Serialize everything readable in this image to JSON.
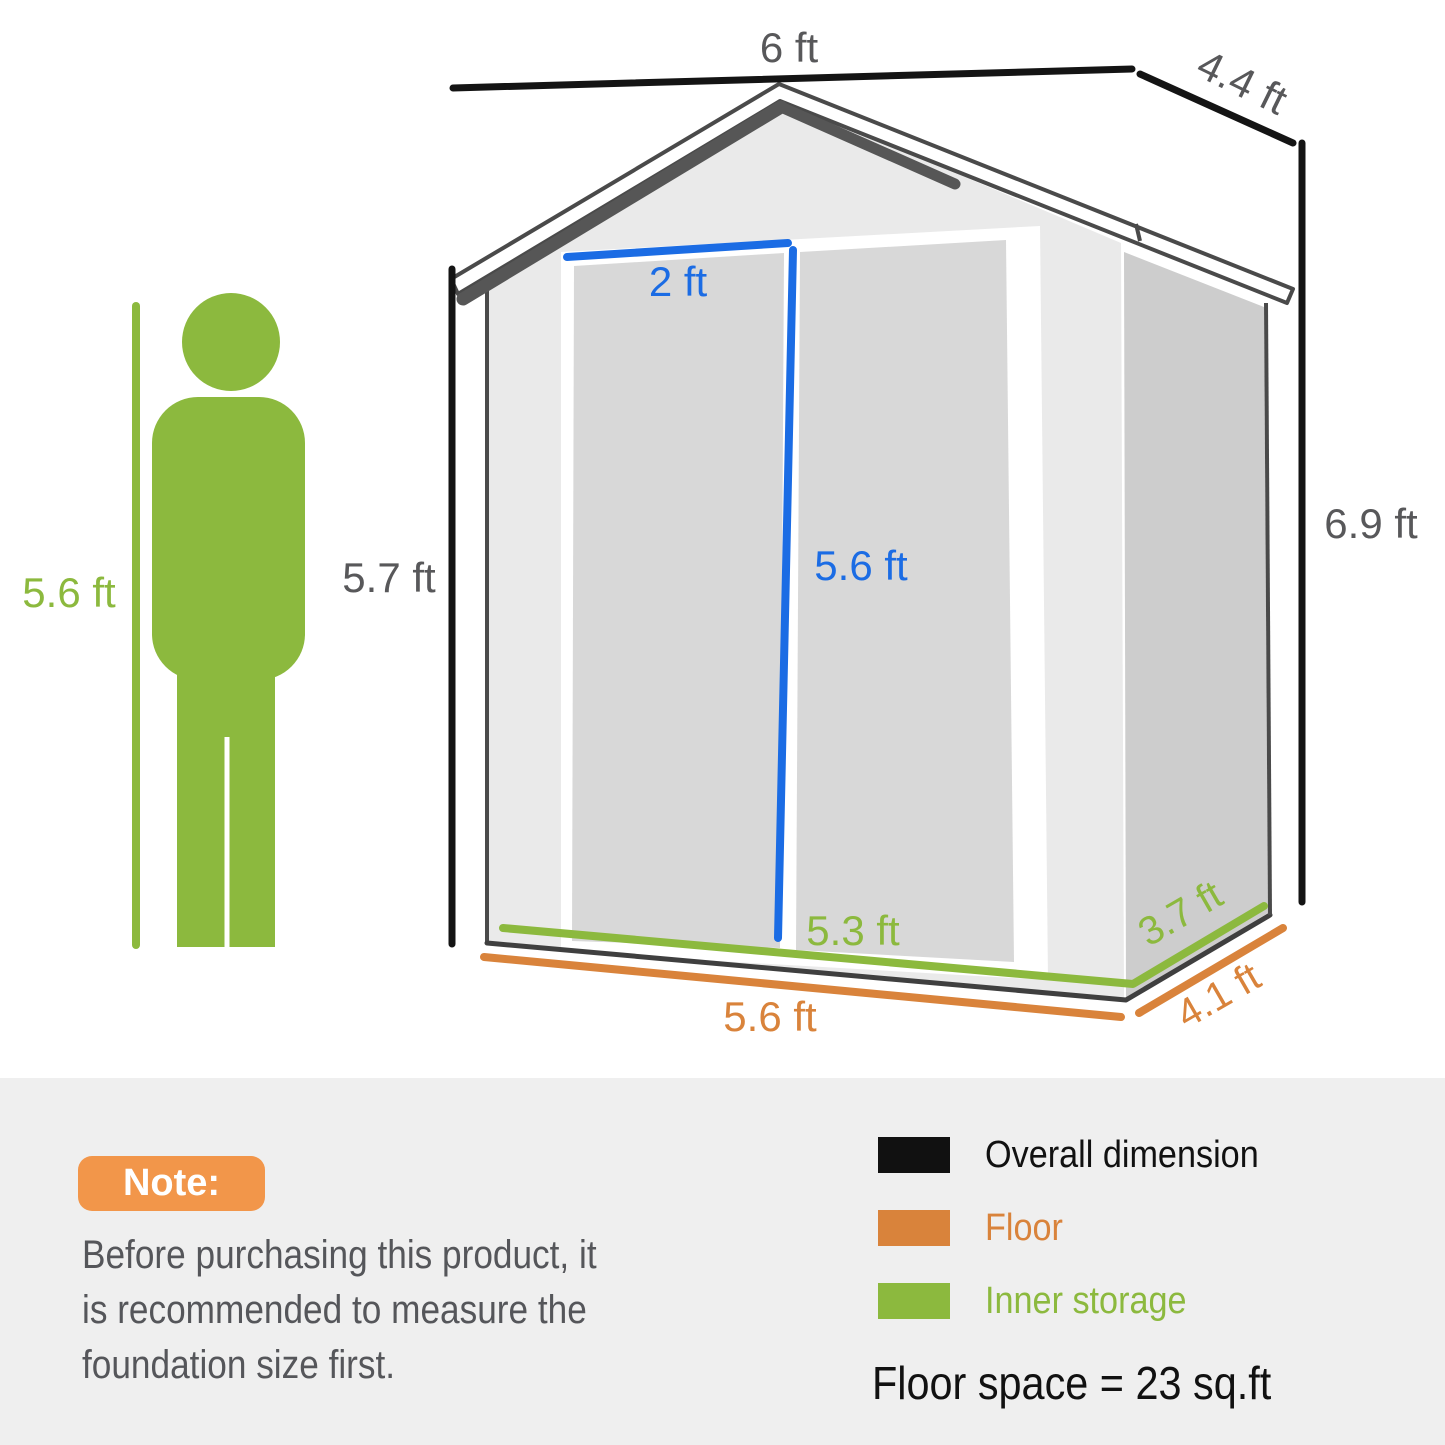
{
  "dimensions": {
    "top_width": "6 ft",
    "top_depth": "4.4 ft",
    "overall_height": "6.9 ft",
    "front_height": "5.7 ft",
    "person_height": "5.6 ft",
    "door_width": "2 ft",
    "door_height": "5.6 ft",
    "inner_width": "5.3 ft",
    "inner_depth": "3.7 ft",
    "floor_width": "5.6 ft",
    "floor_depth": "4.1 ft"
  },
  "note": {
    "badge_label": "Note:",
    "lines": [
      "Before purchasing this product, it",
      "is recommended to measure the",
      "foundation size first."
    ]
  },
  "legend": {
    "items": [
      {
        "label": "Overall dimension",
        "color": "#111111"
      },
      {
        "label": "Floor",
        "color": "#D9833B"
      },
      {
        "label": "Inner storage",
        "color": "#8CB93E"
      }
    ],
    "floor_space": "Floor space = 23 sq.ft"
  },
  "colors": {
    "overall_dimension_black": "#111111",
    "floor_orange": "#D9833B",
    "inner_storage_green": "#8CB93E",
    "door_dimension_blue": "#1B6CE4",
    "note_badge_orange": "#F2964A",
    "label_gray": "#58585A"
  }
}
